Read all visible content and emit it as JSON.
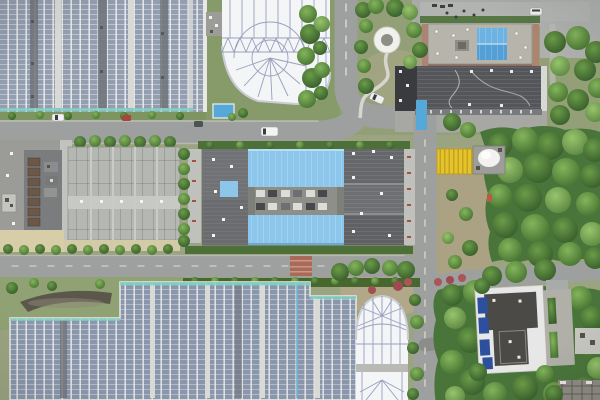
{
  "meta": {
    "type": "aerial-photograph",
    "description": "Top-down drone photo of an industrial treatment-plant campus: two large ground solar arrays, two white membrane-roofed tanks, a central plant building with light-blue roofs, grey workshop buildings, internal roads with a few cars, lawns and dense tree stands",
    "visible_text": "none"
  },
  "colors": {
    "grass_base": "#9aa481",
    "grass_dark": "#869b69",
    "grass_dry": "#ada283",
    "grass_pocket": "#90a173",
    "forest": "#49753a",
    "hedge": "#4c7038",
    "road": "#9ea0a0",
    "road_dash": "#e3e2d6",
    "pavement": "#a9aba9",
    "sidewalk": "#c0c1bc",
    "apron": "#a7a8a4",
    "solar_panel": "#939eb1",
    "solar_panel_dark": "#8a96ab",
    "solar_gap": "#eceded",
    "solar_walkway": "#d9dad6",
    "solar_divider": "#70747a",
    "teal_cap": "#7fd0c0",
    "membrane": "#f4f5f6",
    "membrane_rib": "#8f96b8",
    "blue_roof": "#8cc6ea",
    "blue_pitched": "#57a3d8",
    "blue_small": "#56a8d8",
    "navy_panel": "#2c4f9e",
    "dark_roof": "#55565a",
    "darker_roof": "#3a3b3f",
    "mid_roof": "#6c6d71",
    "concrete_roof": "#b5b8b2",
    "light_block": "#c6c6c0",
    "tan": "#d7cda9",
    "brick": "#b08272",
    "crosswalk": "#aa6a58",
    "yellow": "#e5c32d",
    "yellow_dark": "#c2a41d",
    "white": "#f2f2f0",
    "basin": "#5b574b",
    "scaffold": "#8f8c85"
  },
  "objects": [
    {
      "name": "solar-array-northwest",
      "desc": "rooftop/ground PV array, vertical strings"
    },
    {
      "name": "membrane-roof-north",
      "desc": "white tensile membrane over round tank"
    },
    {
      "name": "office-building-northeast",
      "desc": "flat grey roof with blue pitched section"
    },
    {
      "name": "workshop-building-northeast",
      "desc": "long dark-grey roof building"
    },
    {
      "name": "gazebo",
      "desc": "white circular pavilion with winding footpath"
    },
    {
      "name": "central-plant-building",
      "desc": "plant hall with two light-blue roofs and grey wings"
    },
    {
      "name": "west-plant-building",
      "desc": "concrete-panel roof hall"
    },
    {
      "name": "yellow-canopy",
      "desc": "yellow striped awning beside white storage tank"
    },
    {
      "name": "solar-array-south",
      "desc": "large PV array, stepped edge"
    },
    {
      "name": "membrane-roof-south",
      "desc": "white arched membrane structure"
    },
    {
      "name": "southeast-building",
      "desc": "white-edged building, dark roof with navy PV panels, hedge parking bays"
    },
    {
      "name": "roads",
      "desc": "grey internal roads with dashed centerlines and one brick crosswalk"
    },
    {
      "name": "vehicles",
      "desc": "white van, three small cars, minibus, pedestrians"
    }
  ]
}
